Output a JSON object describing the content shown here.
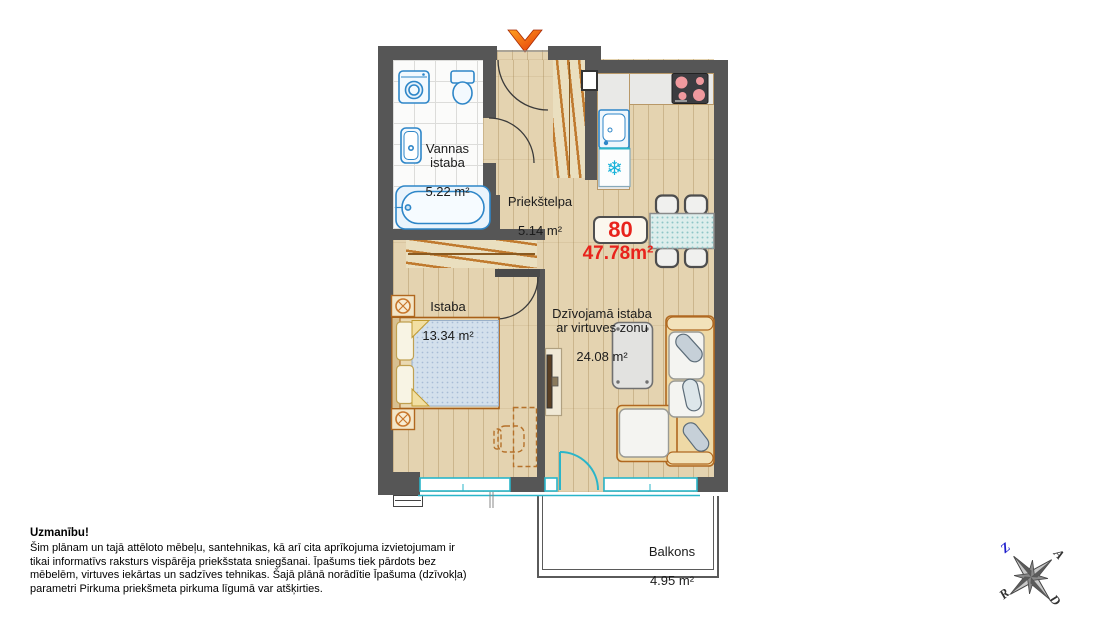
{
  "plan": {
    "apartment": {
      "number": "80",
      "total_area": "47.78m²"
    },
    "rooms": [
      {
        "name": "Vannas\nistaba",
        "area": "5.22 m²"
      },
      {
        "name": "Priekštelpa",
        "area": "5.14 m²"
      },
      {
        "name": "Istaba",
        "area": "13.34 m²"
      },
      {
        "name": "Dzīvojamā istaba\nar virtuves zonu",
        "area": "24.08 m²"
      },
      {
        "name": "Balkons",
        "area": "4.95 m²"
      }
    ]
  },
  "disclaimer": {
    "title": "Uzmanību!",
    "body": "Šim plānam un tajā attēloto mēbeļu, santehnikas, kā arī cita aprīkojuma izvietojumam ir tikai informatīvs raksturs vispārēja priekšstata sniegšanai. Īpašums tiek pārdots bez mēbelēm, virtuves iekārtas un sadzīves tehnikas. Šajā plānā norādītie Īpašuma (dzīvokļa) parametri Pirkuma priekšmeta pirkuma līgumā var atšķirties."
  },
  "compass": {
    "north": "Z",
    "east": "A",
    "south": "D",
    "west": "R"
  },
  "icons": {
    "freezer": "❄",
    "entrance_arrow": "chevron-down"
  },
  "colors": {
    "wall": "#565656",
    "accent_red": "#e8231c",
    "window": "#2ab5c9",
    "fixture_blue": "#2e86c8",
    "furniture_outline": "#b06820",
    "wood_floor": "#e4d3b0"
  }
}
